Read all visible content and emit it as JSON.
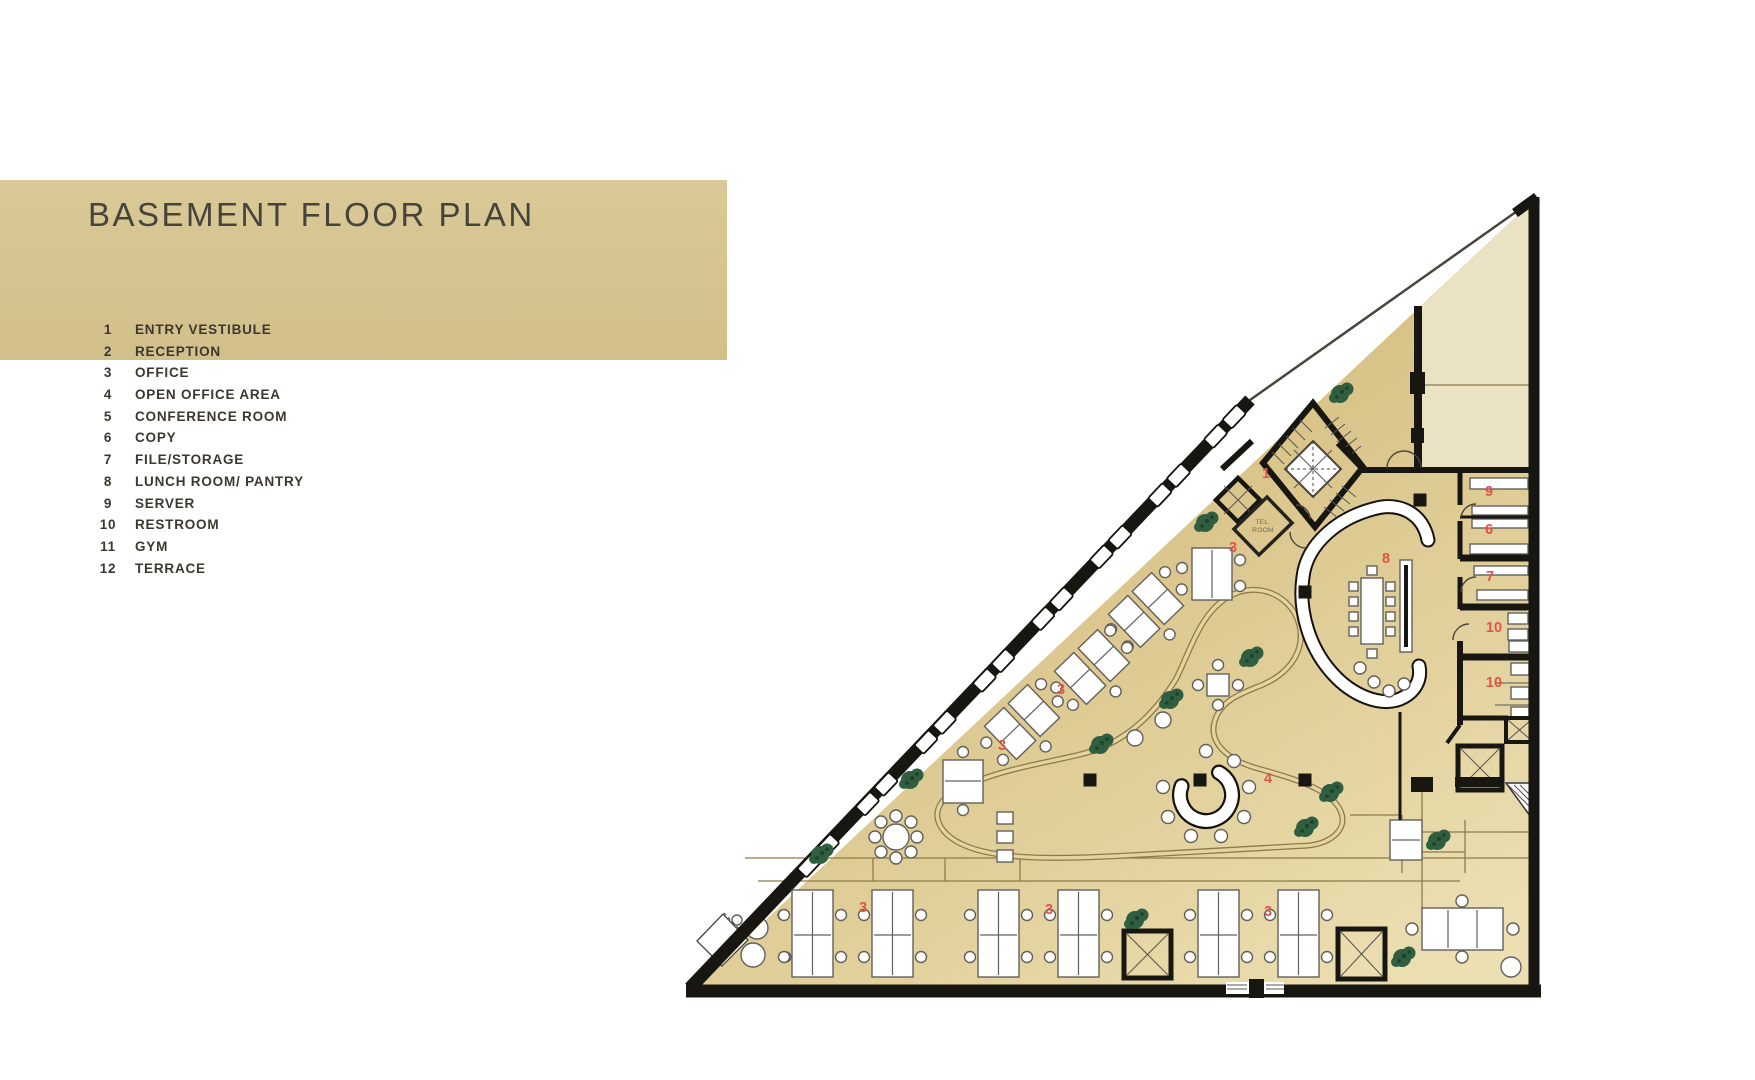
{
  "header": {
    "title": "BASEMENT FLOOR PLAN",
    "band_color": "#d5c492",
    "title_color": "#46433b"
  },
  "legend": {
    "items": [
      {
        "num": "1",
        "label": "ENTRY VESTIBULE"
      },
      {
        "num": "2",
        "label": "RECEPTION"
      },
      {
        "num": "3",
        "label": "OFFICE"
      },
      {
        "num": "4",
        "label": "OPEN OFFICE AREA"
      },
      {
        "num": "5",
        "label": "CONFERENCE ROOM"
      },
      {
        "num": "6",
        "label": "COPY"
      },
      {
        "num": "7",
        "label": "FILE/STORAGE"
      },
      {
        "num": "8",
        "label": "LUNCH ROOM/ PANTRY"
      },
      {
        "num": "9",
        "label": "SERVER"
      },
      {
        "num": "10",
        "label": "RESTROOM"
      },
      {
        "num": "11",
        "label": "GYM"
      },
      {
        "num": "12",
        "label": "TERRACE"
      }
    ]
  },
  "plan": {
    "colors": {
      "wall": "#181611",
      "floor_light": "#ecdfb2",
      "floor_dark": "#d7c185",
      "terrace": "#ebe1c3",
      "room_number": "#e0544a",
      "line": "#8d7b4a",
      "plant": "#2f5e40",
      "plant_dark": "#1e4129",
      "furniture_outline": "#63605a",
      "band": "#d5c492"
    },
    "room_labels": [
      {
        "text": "1",
        "x": 1266,
        "y": 478
      },
      {
        "text": "3",
        "x": 1233,
        "y": 552
      },
      {
        "text": "8",
        "x": 1386,
        "y": 563
      },
      {
        "text": "9",
        "x": 1489,
        "y": 496
      },
      {
        "text": "6",
        "x": 1489,
        "y": 534
      },
      {
        "text": "7",
        "x": 1490,
        "y": 581
      },
      {
        "text": "10",
        "x": 1494,
        "y": 632
      },
      {
        "text": "10",
        "x": 1494,
        "y": 687
      },
      {
        "text": "3",
        "x": 1061,
        "y": 694
      },
      {
        "text": "3",
        "x": 1002,
        "y": 750
      },
      {
        "text": "4",
        "x": 1268,
        "y": 783
      },
      {
        "text": "3",
        "x": 863,
        "y": 912
      },
      {
        "text": "3",
        "x": 1049,
        "y": 914
      },
      {
        "text": "3",
        "x": 1268,
        "y": 916
      }
    ],
    "tel_room": {
      "line1": "TEL.",
      "line2": "ROOM"
    },
    "windows_t": [
      0.045,
      0.145,
      0.25,
      0.355,
      0.46,
      0.565,
      0.67,
      0.775
    ],
    "hyp_wall": {
      "x1": 1250,
      "y1": 400,
      "x2": 693,
      "y2": 988
    },
    "plants": [
      [
        1340,
        394
      ],
      [
        1205,
        523
      ],
      [
        1250,
        658
      ],
      [
        1170,
        700
      ],
      [
        1100,
        745
      ],
      [
        910,
        780
      ],
      [
        820,
        855
      ],
      [
        1305,
        828
      ],
      [
        1330,
        793
      ],
      [
        1135,
        920
      ],
      [
        1437,
        841
      ],
      [
        1402,
        958
      ]
    ],
    "columns": [
      [
        1420,
        500
      ],
      [
        1305,
        592
      ],
      [
        1090,
        780
      ],
      [
        1200,
        780
      ],
      [
        1305,
        780
      ]
    ],
    "bottom_desks_x": [
      792,
      872,
      978,
      1058,
      1198,
      1278
    ],
    "diagonal_desks": [
      [
        1022,
        722
      ],
      [
        1092,
        667
      ],
      [
        1146,
        610
      ]
    ]
  }
}
